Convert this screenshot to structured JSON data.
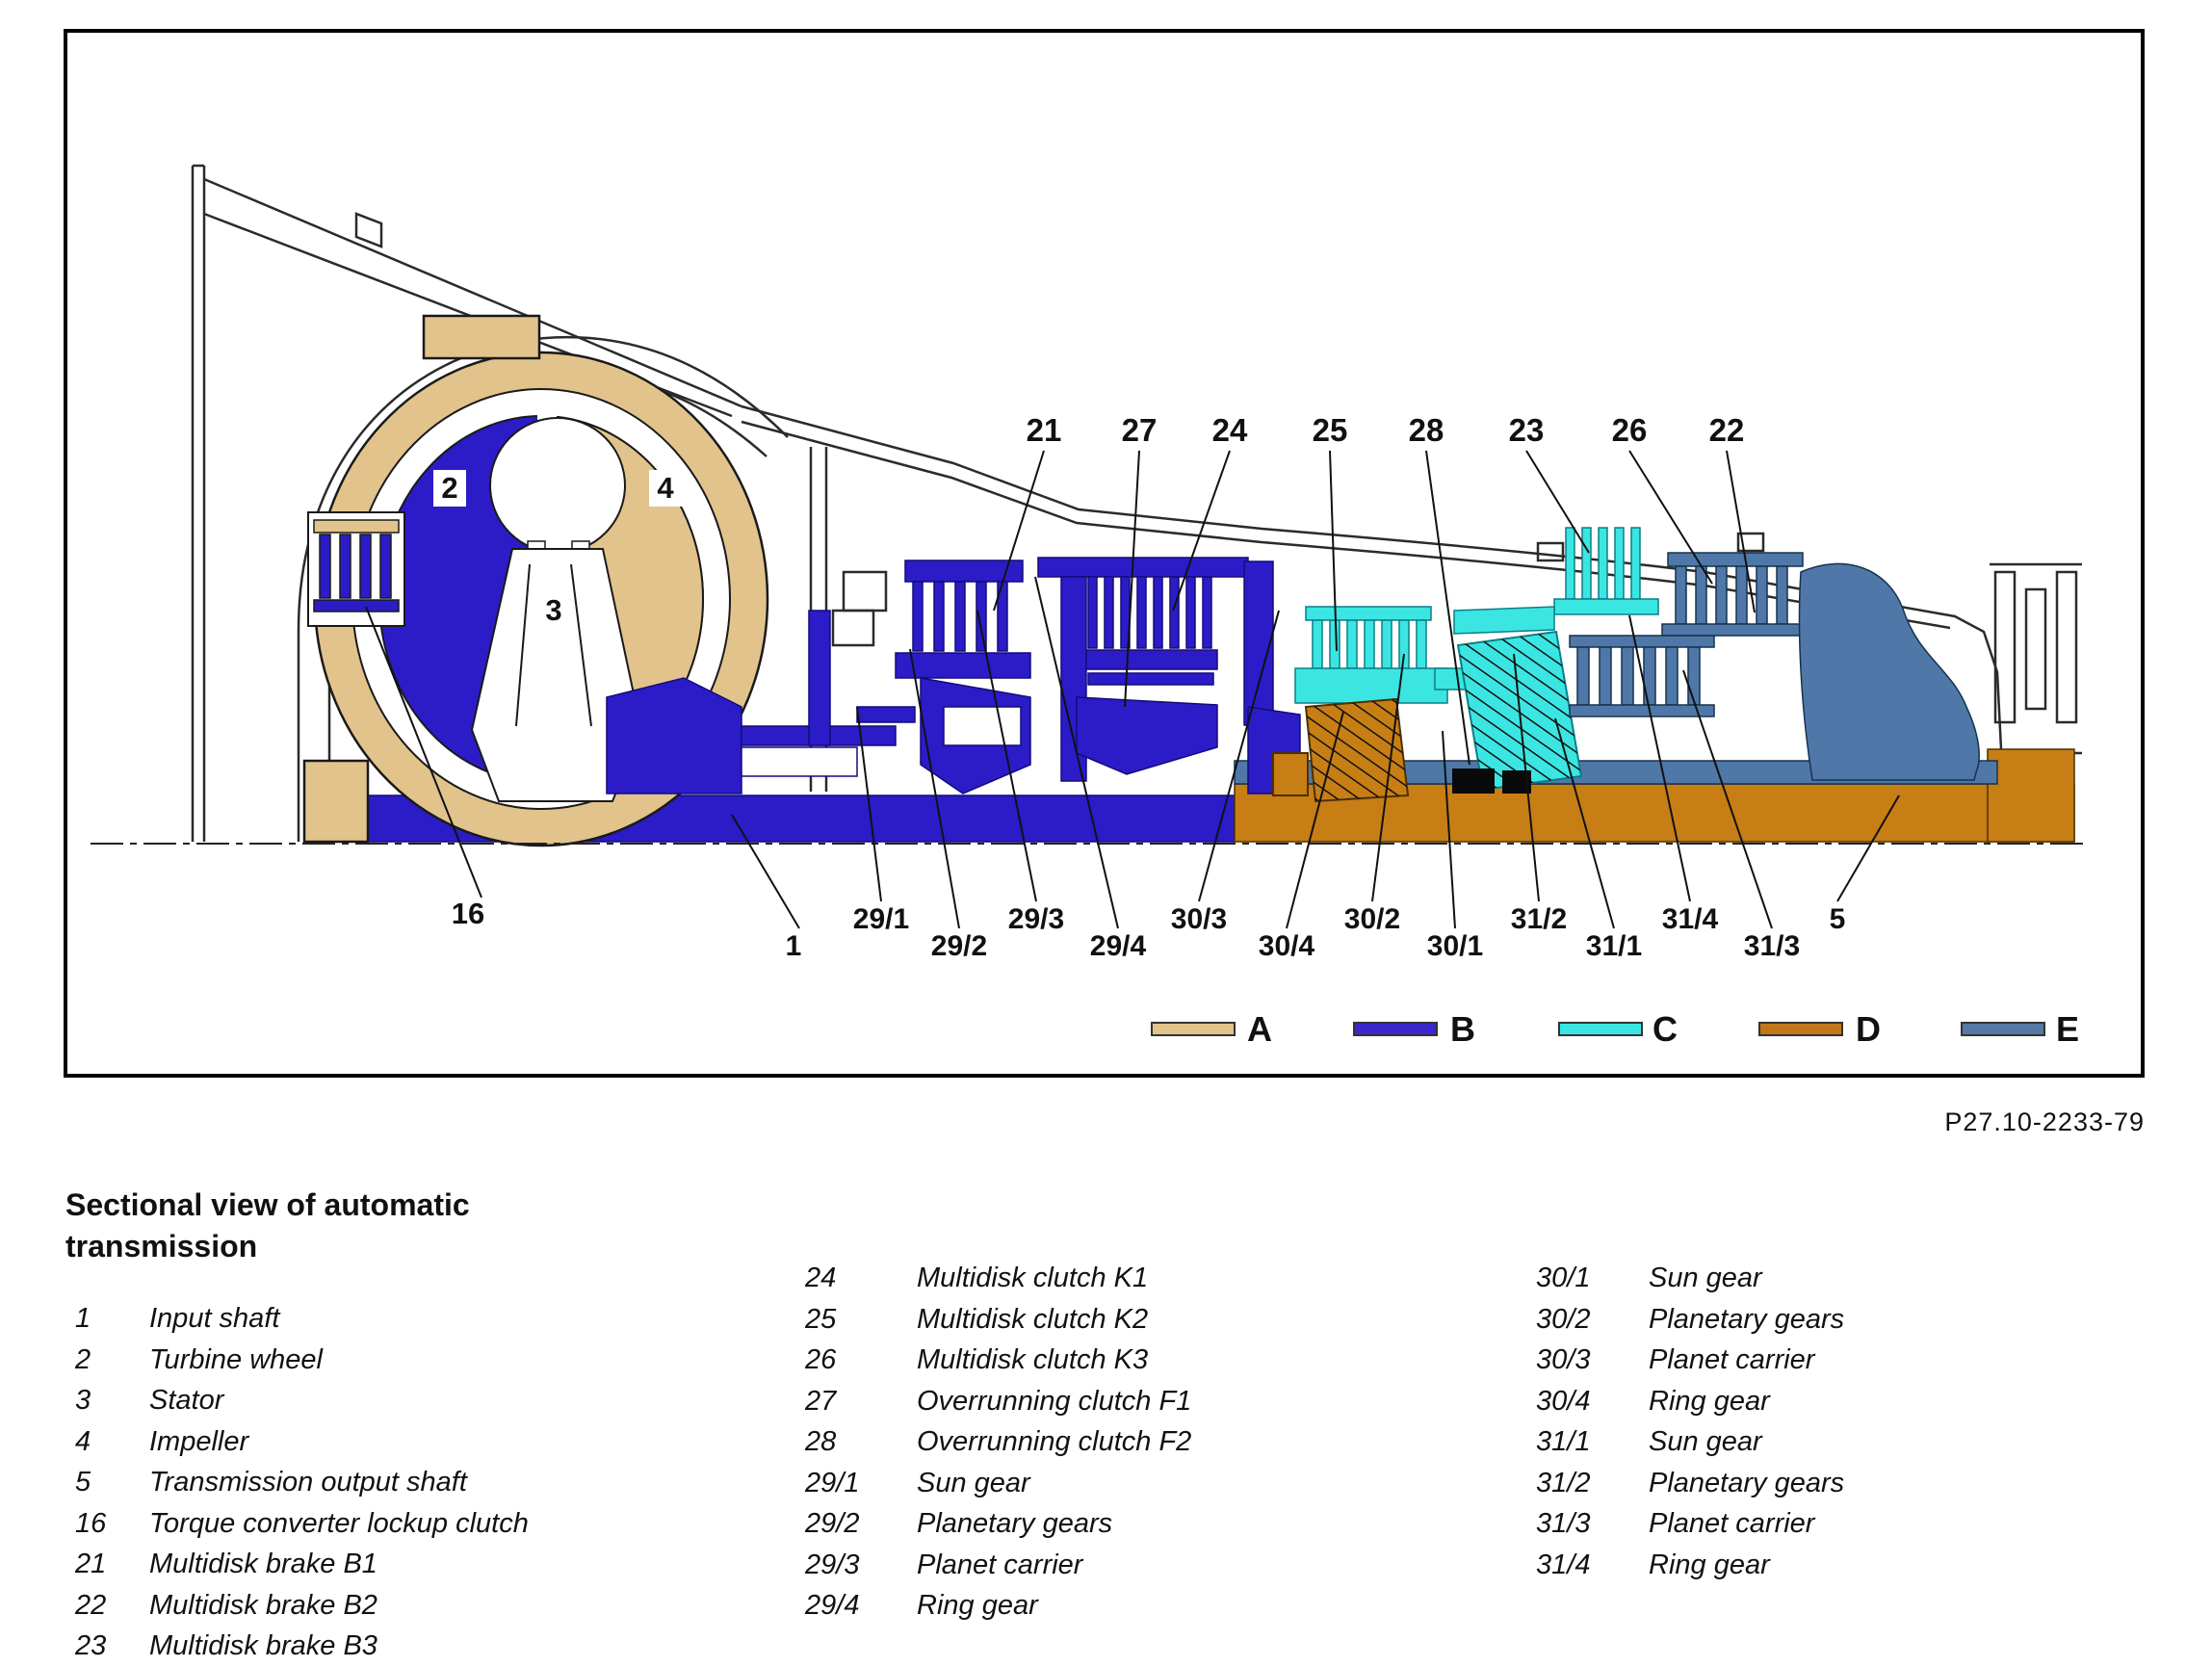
{
  "figure": {
    "reference_code": "P27.10-2233-79",
    "colors": {
      "tan": "#e2c38c",
      "blue": "#2b1cc8",
      "cyan": "#3be6e2",
      "orange": "#c77e15",
      "steel": "#4f78a8",
      "black_part": "#0a0a0a"
    },
    "labels": {
      "l1": "1",
      "l2": "2",
      "l3": "3",
      "l4": "4",
      "l5": "5",
      "l16": "16",
      "l21": "21",
      "l22": "22",
      "l23": "23",
      "l24": "24",
      "l25": "25",
      "l26": "26",
      "l27": "27",
      "l28": "28",
      "l29_1": "29/1",
      "l29_2": "29/2",
      "l29_3": "29/3",
      "l29_4": "29/4",
      "l30_1": "30/1",
      "l30_2": "30/2",
      "l30_3": "30/3",
      "l30_4": "30/4",
      "l31_1": "31/1",
      "l31_2": "31/2",
      "l31_3": "31/3",
      "l31_4": "31/4"
    },
    "legend": [
      {
        "key": "A",
        "color": "#e2c38c"
      },
      {
        "key": "B",
        "color": "#3a28cc"
      },
      {
        "key": "C",
        "color": "#3be6e2"
      },
      {
        "key": "D",
        "color": "#c07818"
      },
      {
        "key": "E",
        "color": "#5379a4"
      }
    ]
  },
  "caption": {
    "title": "Sectional view of automatic\ntransmission"
  },
  "parts_list": {
    "column1": [
      {
        "num": "1",
        "label": "Input shaft"
      },
      {
        "num": "2",
        "label": "Turbine wheel"
      },
      {
        "num": "3",
        "label": "Stator"
      },
      {
        "num": "4",
        "label": "Impeller"
      },
      {
        "num": "5",
        "label": "Transmission output shaft"
      },
      {
        "num": "16",
        "label": "Torque converter lockup clutch"
      },
      {
        "num": "21",
        "label": "Multidisk brake B1"
      },
      {
        "num": "22",
        "label": "Multidisk brake B2"
      },
      {
        "num": "23",
        "label": "Multidisk brake B3"
      }
    ],
    "column2": [
      {
        "num": "24",
        "label": "Multidisk clutch K1"
      },
      {
        "num": "25",
        "label": "Multidisk clutch K2"
      },
      {
        "num": "26",
        "label": "Multidisk clutch K3"
      },
      {
        "num": "27",
        "label": "Overrunning clutch F1"
      },
      {
        "num": "28",
        "label": "Overrunning clutch F2"
      },
      {
        "num": "29/1",
        "label": "Sun gear"
      },
      {
        "num": "29/2",
        "label": "Planetary gears"
      },
      {
        "num": "29/3",
        "label": "Planet carrier"
      },
      {
        "num": "29/4",
        "label": "Ring gear"
      }
    ],
    "column3": [
      {
        "num": "30/1",
        "label": "Sun gear"
      },
      {
        "num": "30/2",
        "label": "Planetary gears"
      },
      {
        "num": "30/3",
        "label": "Planet carrier"
      },
      {
        "num": "30/4",
        "label": "Ring gear"
      },
      {
        "num": "31/1",
        "label": "Sun gear"
      },
      {
        "num": "31/2",
        "label": "Planetary gears"
      },
      {
        "num": "31/3",
        "label": "Planet carrier"
      },
      {
        "num": "31/4",
        "label": "Ring gear"
      }
    ]
  }
}
